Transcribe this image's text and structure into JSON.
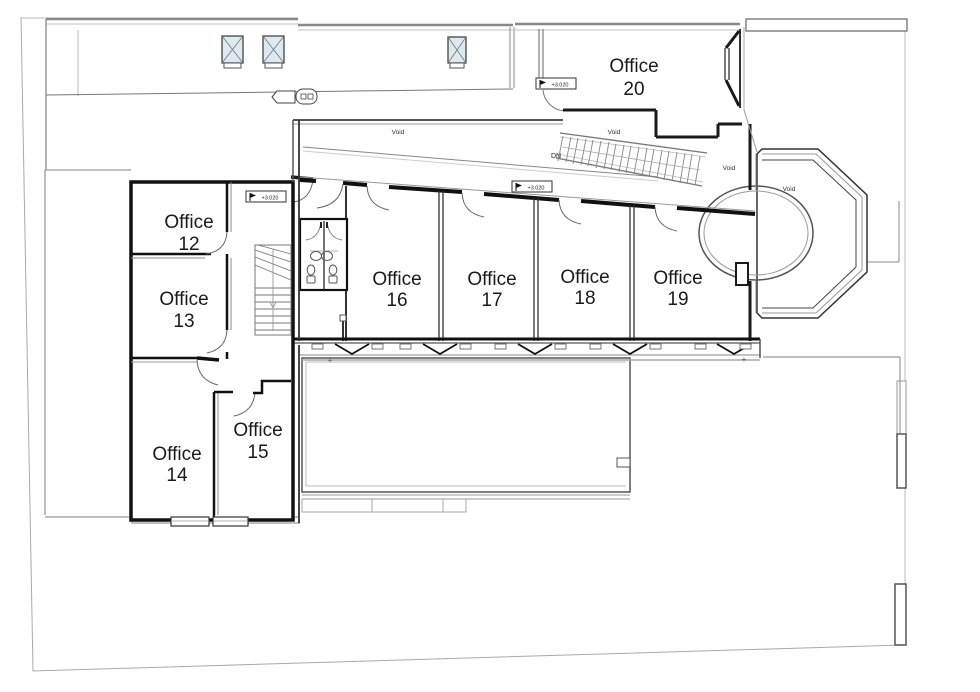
{
  "drawing": {
    "colors": {
      "wall_dark": "#1a1a1a",
      "line_mid": "#555555",
      "line_light": "#9a9a9a",
      "boundary": "#aaaaaa",
      "skylight_fill": "#dce9f0",
      "background": "#ffffff"
    }
  },
  "rooms": [
    {
      "label": "Office",
      "number": "12"
    },
    {
      "label": "Office",
      "number": "13"
    },
    {
      "label": "Office",
      "number": "14"
    },
    {
      "label": "Office",
      "number": "15"
    },
    {
      "label": "Office",
      "number": "16"
    },
    {
      "label": "Office",
      "number": "17"
    },
    {
      "label": "Office",
      "number": "18"
    },
    {
      "label": "Office",
      "number": "19"
    },
    {
      "label": "Office",
      "number": "20"
    }
  ],
  "annotations": {
    "voids": [
      "Void",
      "Void",
      "Void",
      "Void"
    ],
    "stair_down": "DN",
    "levels": [
      "+3.020",
      "+3.020",
      "+3.020"
    ],
    "plus_mark": "+"
  }
}
